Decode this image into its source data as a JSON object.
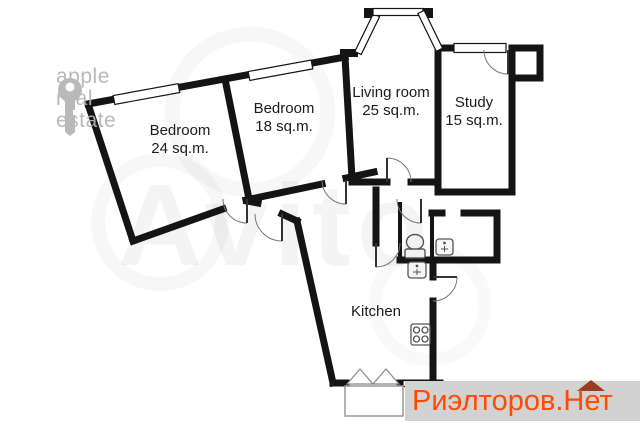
{
  "plan": {
    "type": "apartment-floor-plan",
    "rooms": [
      {
        "name": "Bedroom",
        "area": "24 sq.m."
      },
      {
        "name": "Bedroom",
        "area": "18 sq.m."
      },
      {
        "name": "Living room",
        "area": "25 sq.m."
      },
      {
        "name": "Study",
        "area": "15 sq.m."
      },
      {
        "name": "Kitchen"
      }
    ],
    "fixtures": [
      "toilet",
      "sink",
      "sink",
      "stove",
      "bay-window",
      "balcony",
      "french-door"
    ]
  },
  "watermarks": {
    "agency_logo": {
      "icon": "key-icon",
      "line1": "apple",
      "line2": "real",
      "line3": "estate",
      "color": "#b4b4b4"
    },
    "marketplace": {
      "text": "Avito"
    },
    "listing_banner": {
      "text": "Риэлторов.Нет",
      "text_color": "#ff4a01",
      "bg_color": "#d2d2d2",
      "roof_color": "#9b3c20"
    }
  },
  "colors": {
    "wall": "#141414",
    "background": "#ffffff"
  }
}
